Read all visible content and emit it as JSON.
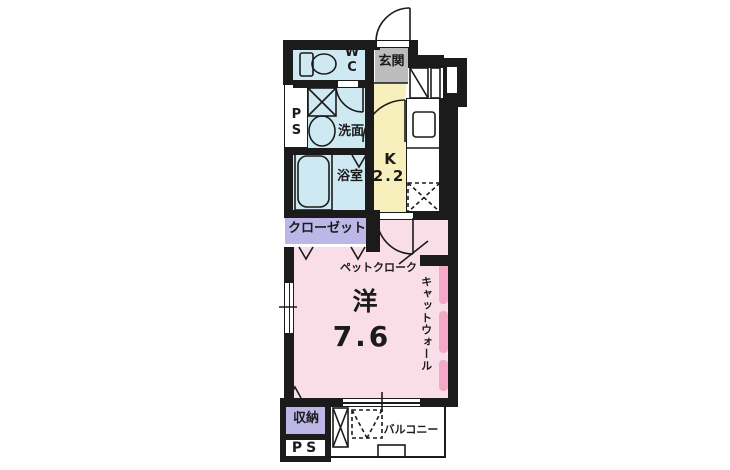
{
  "plan_type": "apartment-floor-plan-1K",
  "colors": {
    "wall": "#1b1b1b",
    "wet_area_blue": "#cfe9f2",
    "entrance_gray": "#bcbcbc",
    "kitchen_yellow": "#f7f0bd",
    "closet_lavender": "#bcb7e6",
    "room_pink": "#f9dde7",
    "cat_wall_pink": "#f4a9c9",
    "balcony_white": "#ffffff"
  },
  "labels": {
    "wc": [
      "W",
      "C"
    ],
    "entrance": "玄関",
    "ps_upper": "PS",
    "washroom": "洗面",
    "bathroom": "浴室",
    "kitchen_k": "K",
    "kitchen_area": "2.2",
    "closet": "クローゼット",
    "pet_cloak": "ペットクローク",
    "room_kanji": "洋",
    "room_area": "7.6",
    "cat_wall": "キャットウォール",
    "storage": "収納",
    "ps_lower": "PS",
    "balcony": "バルコニー"
  }
}
